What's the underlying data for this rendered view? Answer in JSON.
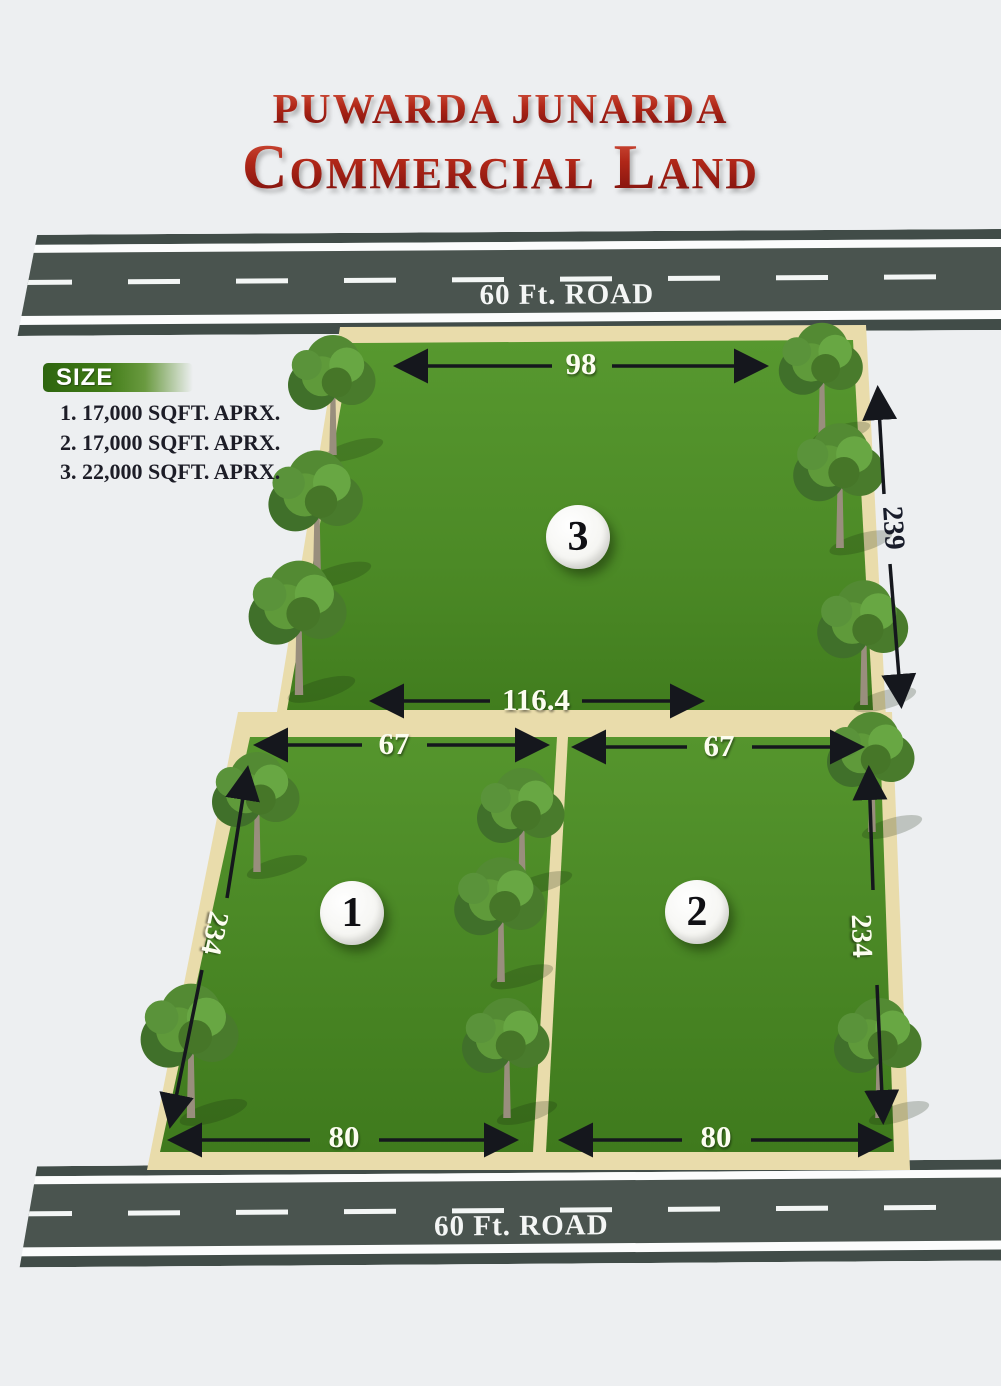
{
  "title": {
    "line1": "PUWARDA JUNARDA",
    "line2": "Commercial Land"
  },
  "roads": {
    "top": {
      "label": "60 Ft. ROAD"
    },
    "bottom": {
      "label": "60 Ft. ROAD"
    }
  },
  "legend": {
    "header": "SIZE",
    "items": [
      "1. 17,000 SQFT. APRX.",
      "2. 17,000 SQFT. APRX.",
      "3. 22,000 SQFT. APRX."
    ]
  },
  "plots": [
    {
      "number": "1",
      "area": "17,000 SQFT. APRX.",
      "dims": {
        "top": "67",
        "bottom": "80",
        "side": "234"
      }
    },
    {
      "number": "2",
      "area": "17,000 SQFT. APRX.",
      "dims": {
        "top": "67",
        "bottom": "80",
        "side": "234"
      }
    },
    {
      "number": "3",
      "area": "22,000 SQFT. APRX.",
      "dims": {
        "top": "98",
        "bottom": "116.4",
        "side": "239"
      }
    }
  ],
  "colors": {
    "title_red": "#a32017",
    "grass": "#4f8c28",
    "road": "#4a544f",
    "sand_border": "#e9dcab",
    "arrow": "#15171d",
    "background": "#edeff1"
  }
}
